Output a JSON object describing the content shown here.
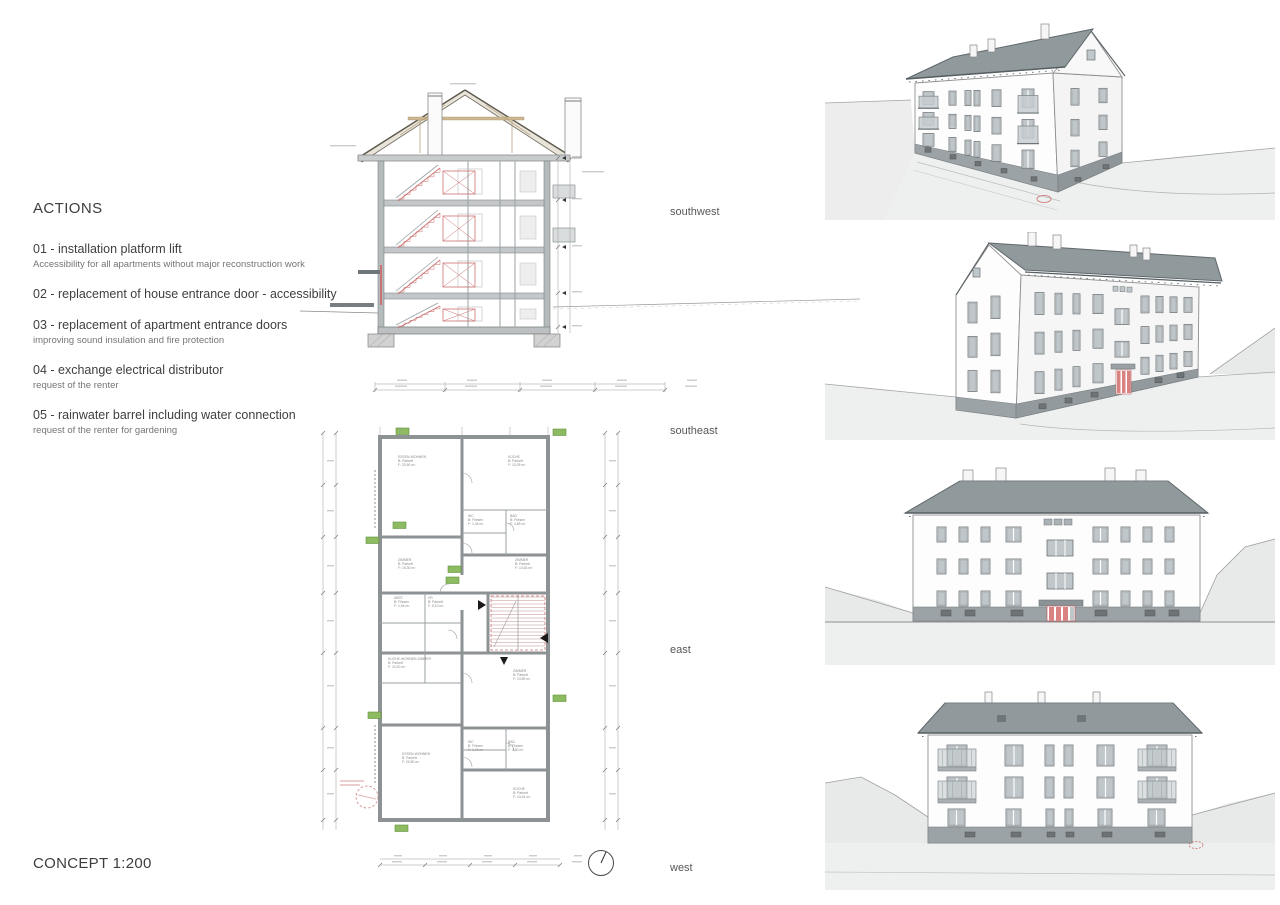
{
  "sheet": {
    "concept_label": "CONCEPT 1:200"
  },
  "actions": {
    "heading": "ACTIONS",
    "items": [
      {
        "title": "01 - installation platform lift",
        "subtitle": "Accessibility for all apartments without major reconstruction work"
      },
      {
        "title": "02 - replacement of house entrance door - accessibility",
        "subtitle": ""
      },
      {
        "title": "03 - replacement of apartment entrance doors",
        "subtitle": "improving sound insulation and fire protection"
      },
      {
        "title": "04 - exchange electrical distributor",
        "subtitle": "request of the renter"
      },
      {
        "title": "05 - rainwater barrel including water connection",
        "subtitle": "request of the renter for gardening"
      }
    ]
  },
  "views": [
    {
      "label": "southwest"
    },
    {
      "label": "southeast"
    },
    {
      "label": "east"
    },
    {
      "label": "west"
    }
  ],
  "plan": {
    "rooms": [
      {
        "name": "ESSEN-WOHNEN",
        "floor": "B: Parkett",
        "area": "F: 20,50 m²"
      },
      {
        "name": "KÜCHE",
        "floor": "B: Parkett",
        "area": "F: 13,09 m²"
      },
      {
        "name": "BAD",
        "floor": "B: Fliesen",
        "area": "F: 4,85 m²"
      },
      {
        "name": "WC",
        "floor": "B: Fliesen",
        "area": "F: 1,45 m²"
      },
      {
        "name": "ZIMMER",
        "floor": "B: Parkett",
        "area": "F: 15,30 m²"
      },
      {
        "name": "ZIMMER",
        "floor": "B: Parkett",
        "area": "F: 13,63 m²"
      },
      {
        "name": "VR",
        "floor": "B: Parkett",
        "area": "F: 5,10 m²"
      },
      {
        "name": "ABST.",
        "floor": "B: Fliesen",
        "area": "F: 1,54 m²"
      },
      {
        "name": "KÜCHE-WOHNEN-ZIMMER",
        "floor": "B: Parkett",
        "area": "F: 24,20 m²"
      },
      {
        "name": "ZIMMER",
        "floor": "B: Parkett",
        "area": "F: 13,89 m²"
      },
      {
        "name": "BAD",
        "floor": "B: Fliesen",
        "area": "F: 4,80 m²"
      },
      {
        "name": "WC",
        "floor": "B: Fliesen",
        "area": "F: 1,40 m²"
      },
      {
        "name": "ESSEN-WOHNEN",
        "floor": "B: Parkett",
        "area": "F: 20,80 m²"
      },
      {
        "name": "KÜCHE",
        "floor": "B: Parkett",
        "area": "F: 13,44 m²"
      }
    ]
  },
  "colors": {
    "accent_red": "#cc7272",
    "marker_green": "#8cbb61",
    "roof_gray": "#90999c",
    "plinth_gray": "#9ca3a6",
    "ground_gray": "#eef0f0",
    "text_dark": "#3e3e3e"
  }
}
